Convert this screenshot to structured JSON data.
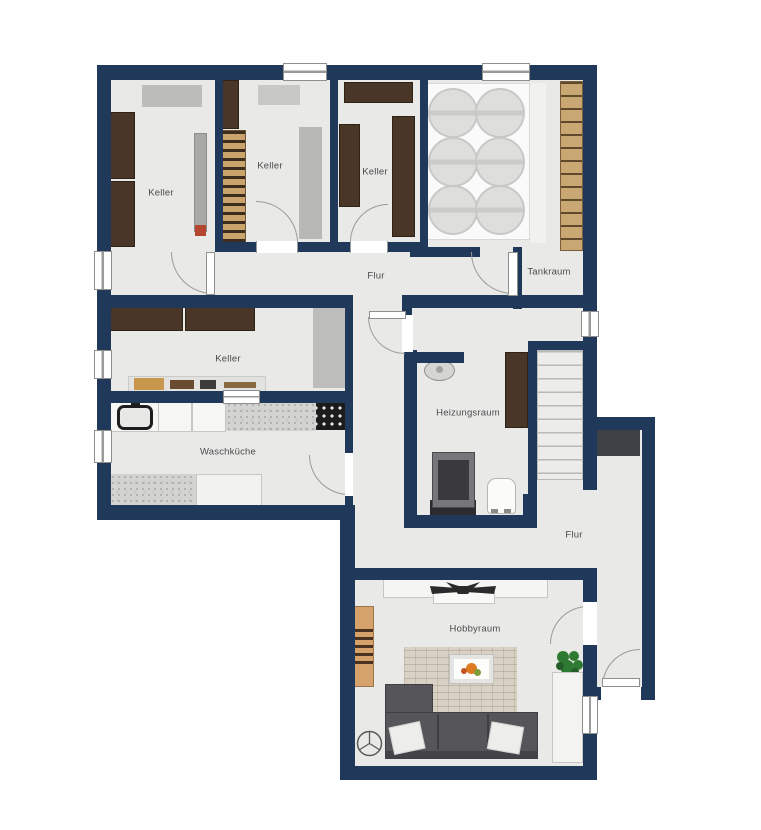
{
  "meta": {
    "title": "Basement floor plan (Kellergeschoss)",
    "plan_type": "2D architectural floor plan, top view"
  },
  "colors": {
    "wall": "#20395b",
    "floor": "#e9e9e8",
    "background": "#ffffff",
    "furniture_brown": "#4a3627",
    "wine_rack_tan": "#c9a46c",
    "sofa_gray": "#55555a",
    "plant_green": "#2f7a33",
    "entry_mat_dark": "#3e4247"
  },
  "rooms": [
    {
      "id": "keller-top-left",
      "label": "Keller"
    },
    {
      "id": "keller-top-middle",
      "label": "Keller"
    },
    {
      "id": "keller-top-right",
      "label": "Keller"
    },
    {
      "id": "tankraum",
      "label": "Tankraum"
    },
    {
      "id": "flur-upper",
      "label": "Flur"
    },
    {
      "id": "keller-middle",
      "label": "Keller"
    },
    {
      "id": "waschkueche",
      "label": "Waschküche"
    },
    {
      "id": "heizungsraum",
      "label": "Heizungsraum"
    },
    {
      "id": "flur-lower",
      "label": "Flur"
    },
    {
      "id": "hobbyraum",
      "label": "Hobbyraum"
    }
  ],
  "fixtures": [
    "storage shelves (dark brown) in all Keller rooms",
    "wine rack with bottle rows in middle top Keller",
    "six round tanks on platform in Tankraum",
    "wood-tread shelf/steps along Tankraum right wall",
    "workbench with tools in middle Keller",
    "sink, two washing machines, counter and dark hob unit in Waschküche",
    "floor mats in Waschküche",
    "wash basin, boiler, white tank and shelf in Heizungsraum",
    "staircase next to Heizungsraum",
    "dark doormat in entry Flur",
    "sideboard with ceiling fan, wine shelf, rug with coffee table and fruit bowl, corner sofa with pillows, floor fan symbol, plant and console in Hobbyraum"
  ]
}
